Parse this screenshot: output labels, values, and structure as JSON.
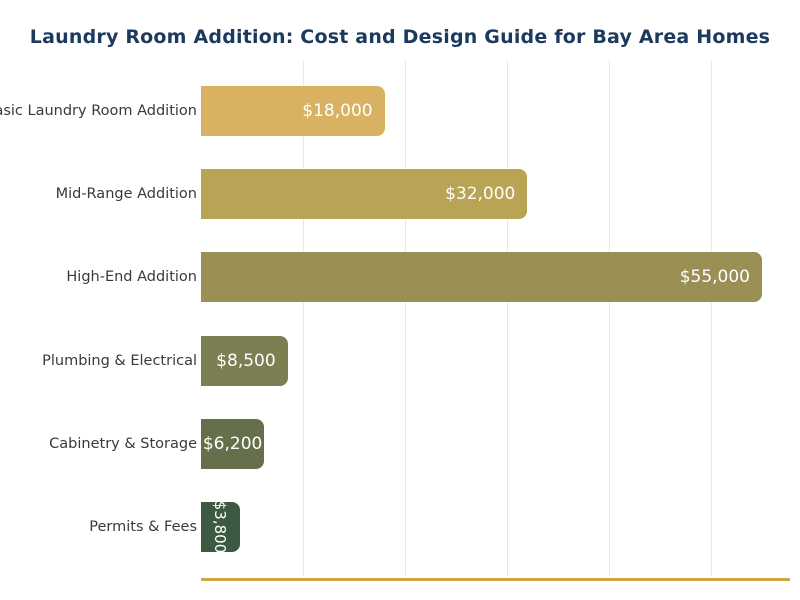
{
  "chart_data": {
    "type": "bar",
    "orientation": "horizontal",
    "title": "Laundry Room Addition: Cost and Design Guide for Bay Area Homes",
    "categories": [
      "Basic Laundry Room Addition",
      "Mid-Range Addition",
      "High-End Addition",
      "Plumbing & Electrical",
      "Cabinetry & Storage",
      "Permits & Fees"
    ],
    "values": [
      18000,
      32000,
      55000,
      8500,
      6200,
      3800
    ],
    "value_labels": [
      "$18,000",
      "$32,000",
      "$55,000",
      "$8,500",
      "$6,200",
      "$3,800"
    ],
    "bar_colors": [
      "#d8b262",
      "#b9a355",
      "#9a8f55",
      "#7b7f52",
      "#656f4b",
      "#3b5a41"
    ],
    "xlabel": "",
    "ylabel": "",
    "xlim": [
      0,
      57750
    ],
    "gridline_interval": 10000,
    "grid": true,
    "legend": "none",
    "colors": {
      "title": "#1c3a5e",
      "category_label": "#3a3a3a",
      "value_label": "#ffffff",
      "gridline": "#e9e9e9",
      "axis_line": "#d4a545",
      "background": "#ffffff"
    }
  }
}
